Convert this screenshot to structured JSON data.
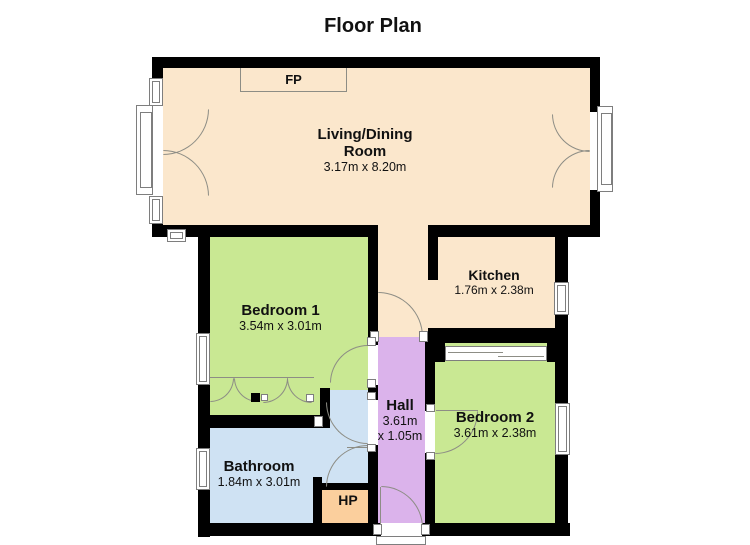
{
  "title": "Floor Plan",
  "colors": {
    "background": "#ffffff",
    "wall": "#000000",
    "living_room": "#fbe7cc",
    "bedroom": "#c9e893",
    "hall": "#dbb3eb",
    "bathroom": "#cfe2f3",
    "hot_press": "#fbcf9d",
    "door_line": "#8d8d85",
    "window_frame": "#7e7e7e",
    "label_text": "#111111"
  },
  "rooms": {
    "living": {
      "name_line1": "Living/Dining",
      "name_line2": "Room",
      "dims": "3.17m x 8.20m"
    },
    "kitchen": {
      "name": "Kitchen",
      "dims": "1.76m x 2.38m"
    },
    "bedroom1": {
      "name": "Bedroom 1",
      "dims": "3.54m x 3.01m"
    },
    "bedroom2": {
      "name": "Bedroom 2",
      "dims": "3.61m x 2.38m"
    },
    "hall": {
      "name": "Hall",
      "dims_line1": "3.61m",
      "dims_line2": "x 1.05m"
    },
    "bathroom": {
      "name": "Bathroom",
      "dims": "1.84m x 3.01m"
    },
    "hot_press": {
      "name": "HP"
    },
    "fireplace": {
      "name": "FP"
    }
  }
}
